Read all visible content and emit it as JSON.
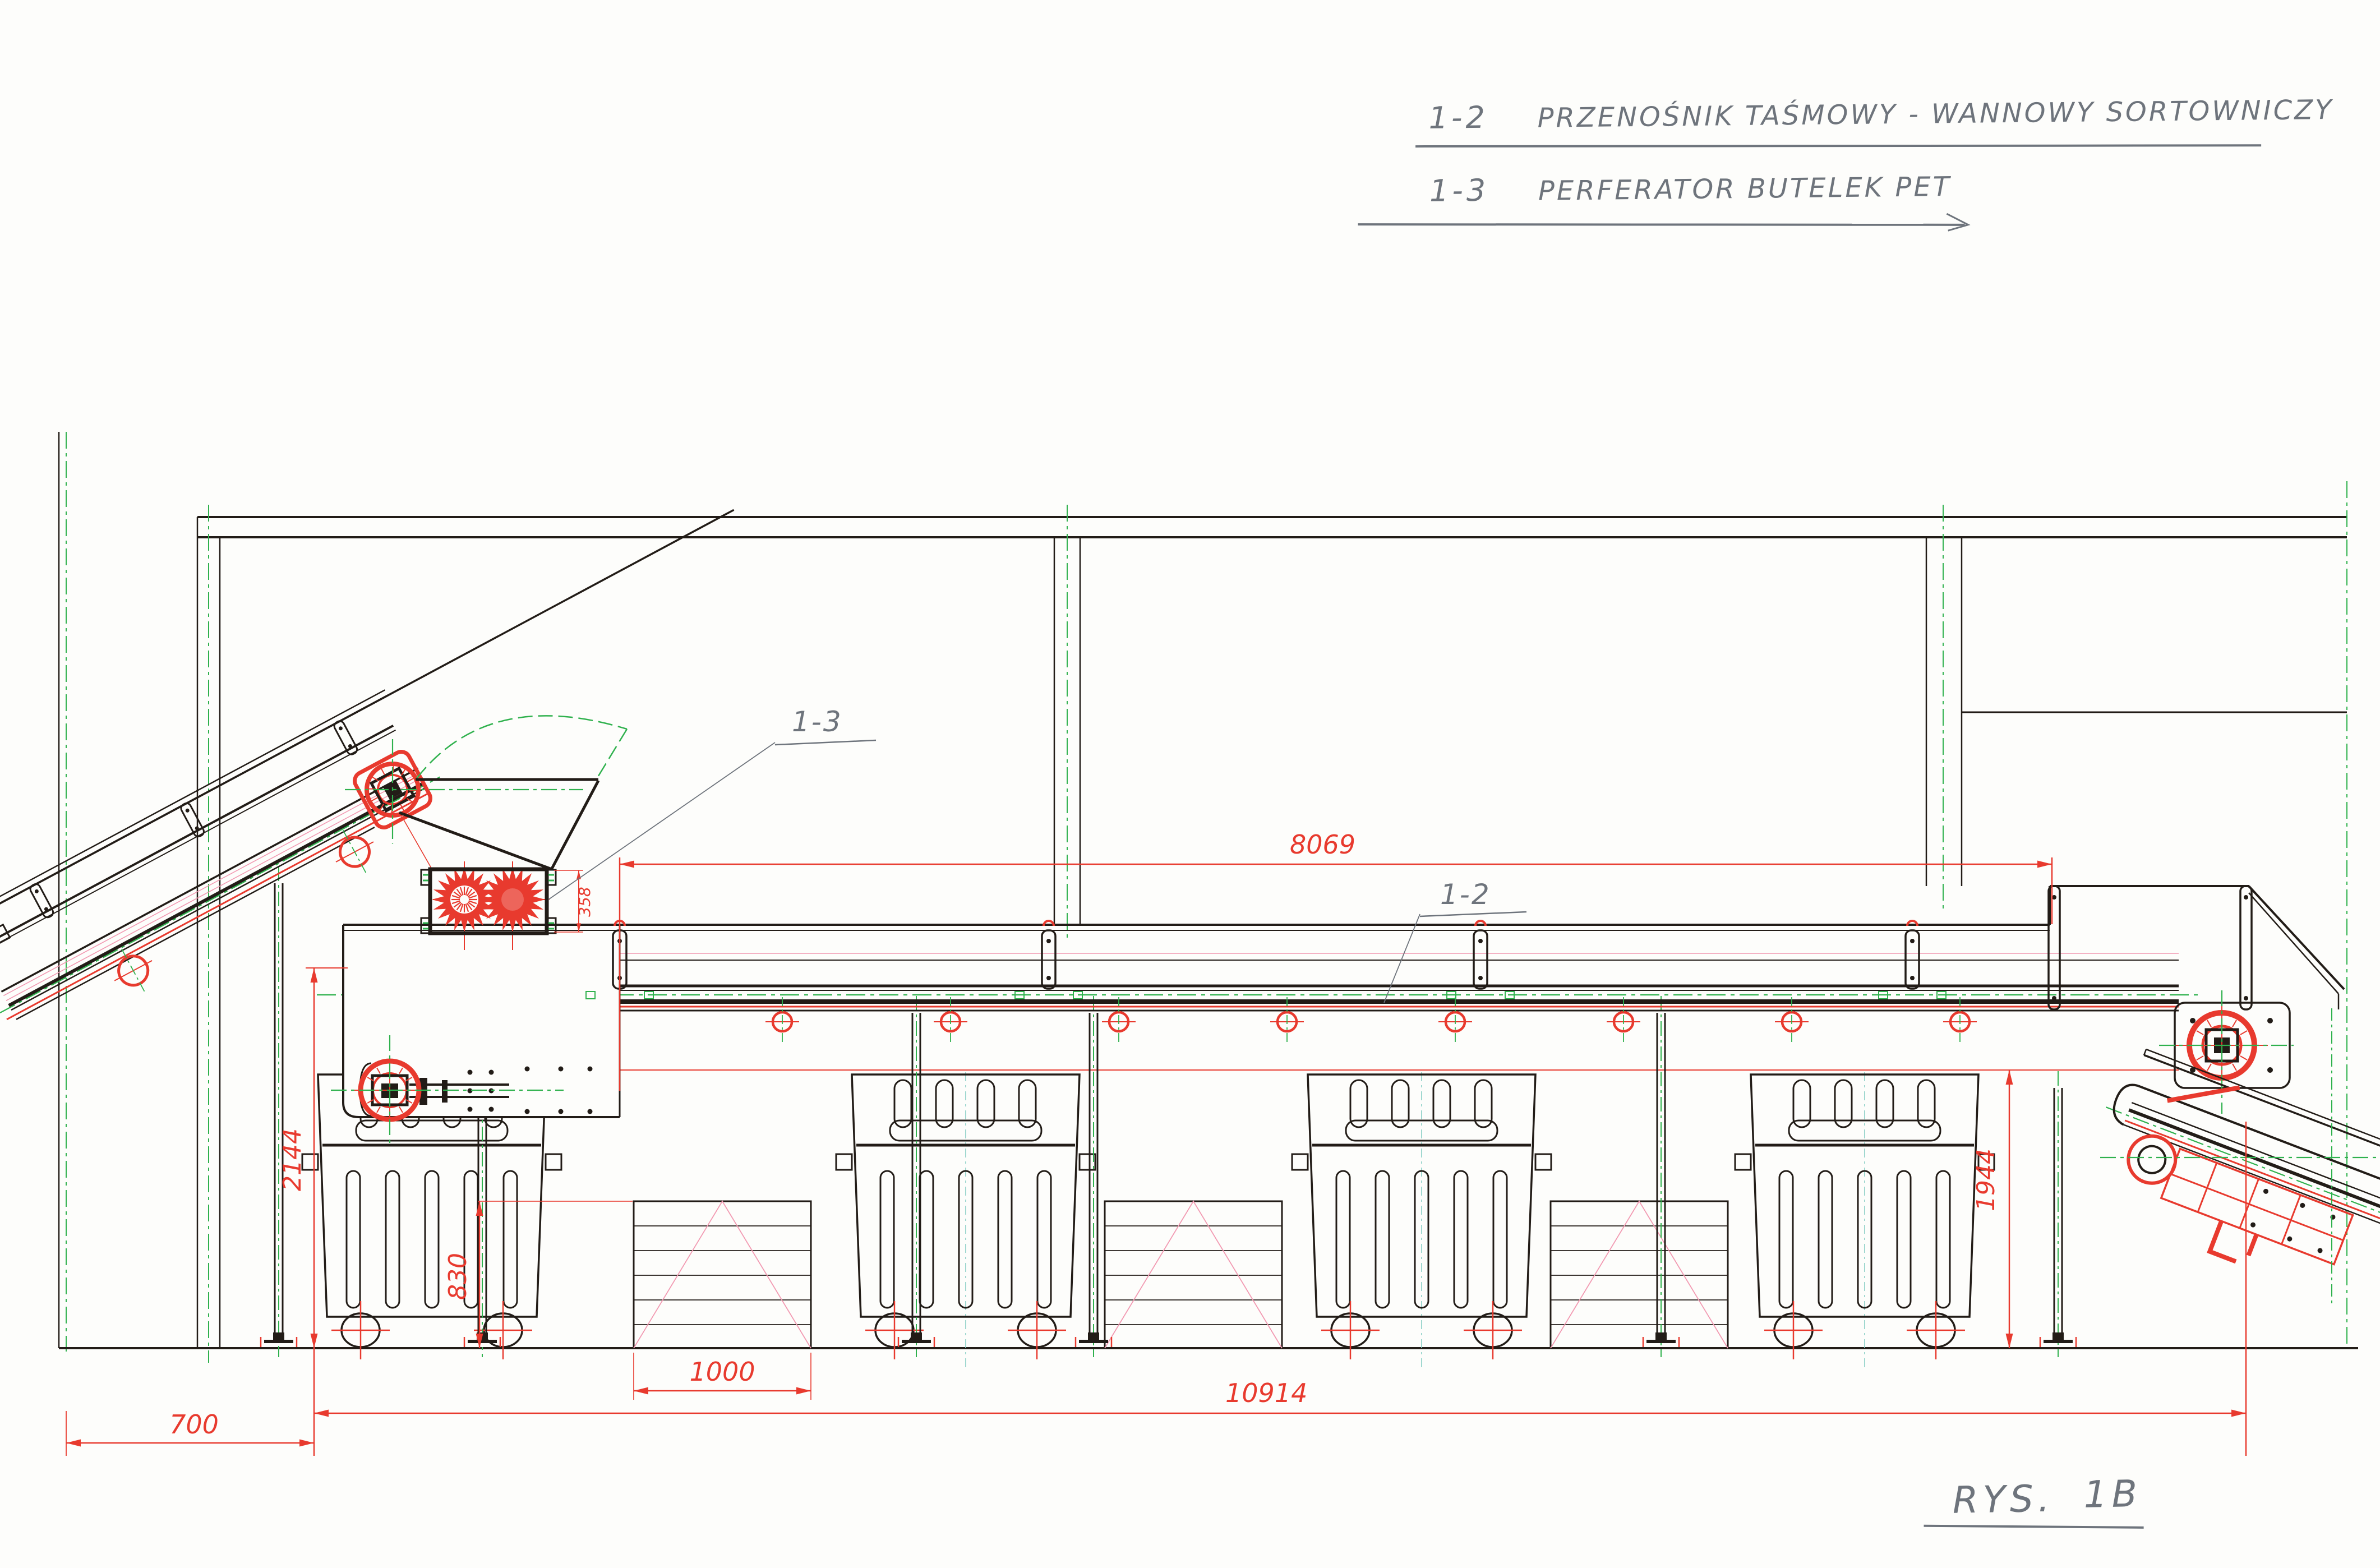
{
  "drawing": {
    "legend": {
      "items": [
        {
          "code": "1-2",
          "label": "PRZENOŚNIK TAŚMOWY - WANNOWY SORTOWNICZY"
        },
        {
          "code": "1-3",
          "label": "PERFERATOR BUTELEK PET"
        }
      ]
    },
    "callouts": {
      "main_conveyor": "1-2",
      "perforator": "1-3"
    },
    "figure": {
      "prefix": "RYS.",
      "number": "1B"
    },
    "dimensions_mm": {
      "total_length": "10914",
      "sorting_conveyor_length": "8069",
      "belt_height_left": "2144",
      "belt_height_right": "1944",
      "pallet_stack_height": "830",
      "pallet_width": "1000",
      "wall_clearance": "700",
      "perforator_height": "358"
    },
    "colors": {
      "paper": "#fdfdfb",
      "line_black": "#221c17",
      "dimension_red": "#e83a2e",
      "centerline_green": "#2fb14d",
      "pink_accent": "#f29ab2",
      "teal_centerline": "#8ad0c6",
      "pencil_gray": "#6e747c"
    }
  }
}
